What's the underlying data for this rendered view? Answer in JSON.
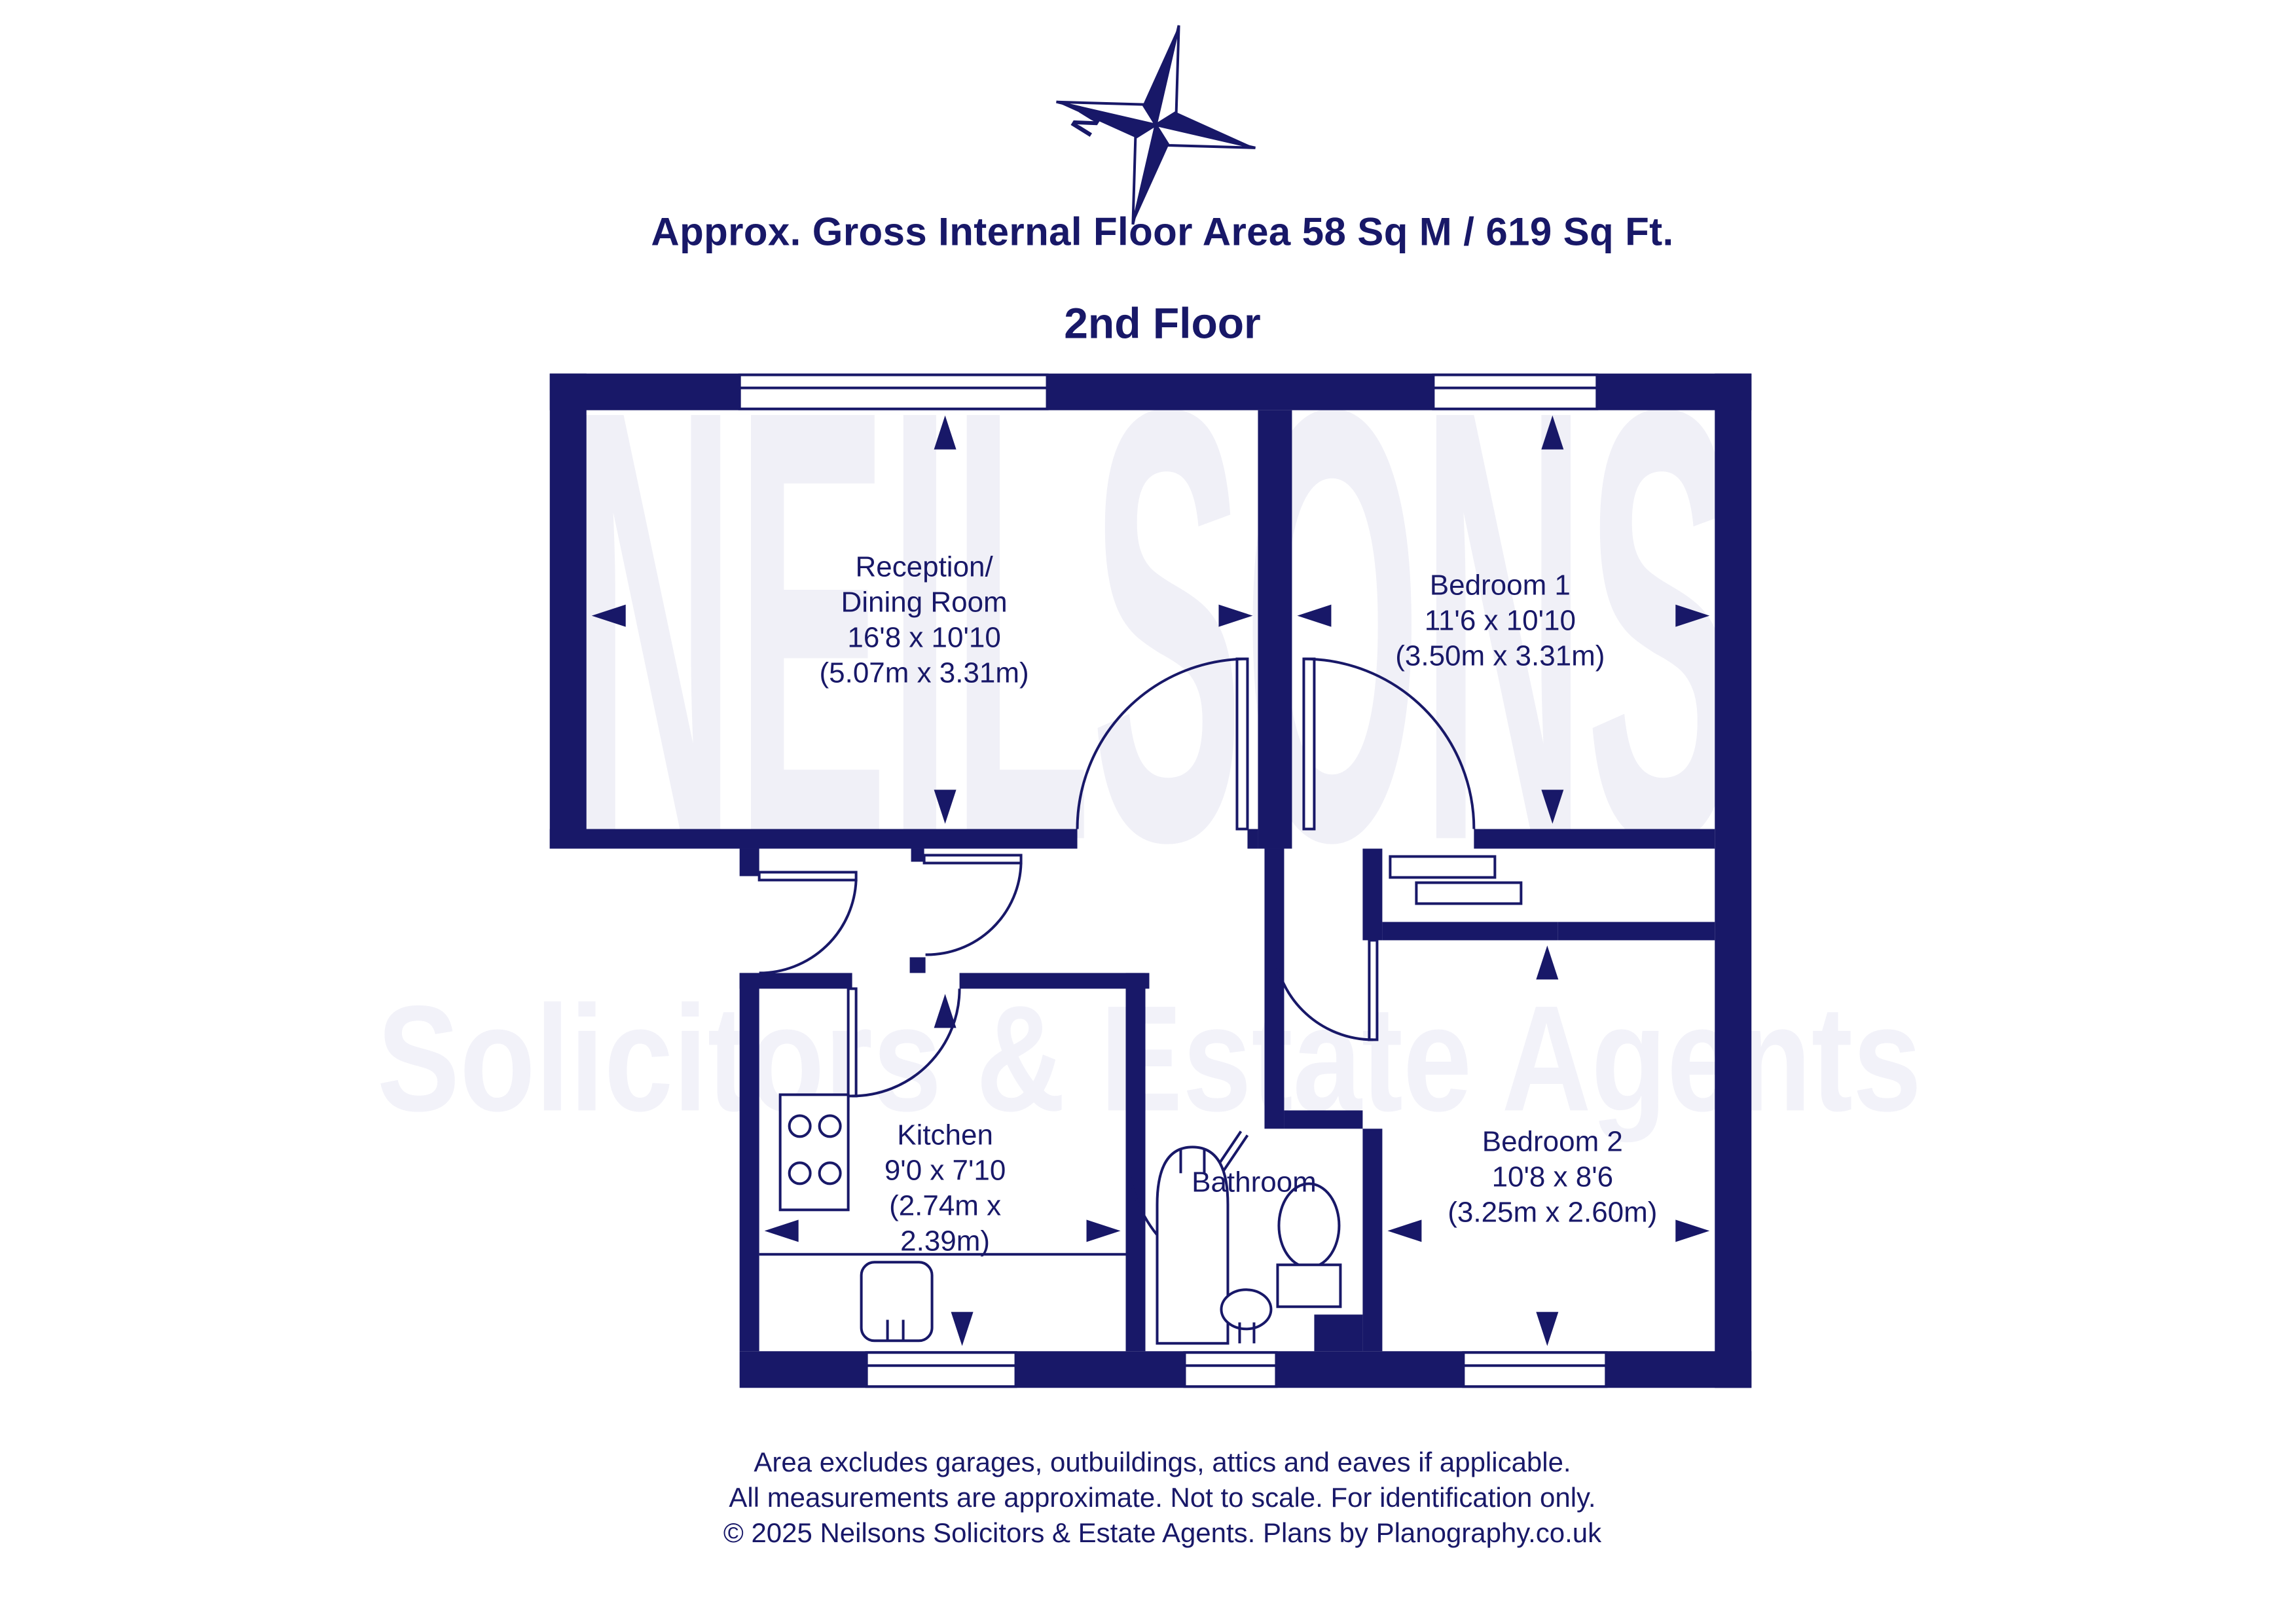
{
  "header": {
    "area_line": "Approx. Gross Internal Floor Area 58 Sq M / 619 Sq Ft.",
    "floor_title": "2nd Floor",
    "compass_north_label": "N"
  },
  "watermark": {
    "line1": "NEILSONS",
    "line2": "Solicitors & Estate Agents"
  },
  "rooms": {
    "reception": {
      "name1": "Reception/",
      "name2": "Dining Room",
      "dims_imperial": "16'8 x 10'10",
      "dims_metric": "(5.07m x 3.31m)"
    },
    "bedroom1": {
      "name": "Bedroom 1",
      "dims_imperial": "11'6 x 10'10",
      "dims_metric": "(3.50m x 3.31m)"
    },
    "kitchen": {
      "name": "Kitchen",
      "dims_imperial": "9'0 x 7'10",
      "dims_metric_line1": "(2.74m x",
      "dims_metric_line2": "2.39m)"
    },
    "bathroom": {
      "name": "Bathroom"
    },
    "bedroom2": {
      "name": "Bedroom 2",
      "dims_imperial": "10'8 x 8'6",
      "dims_metric": "(3.25m x 2.60m)"
    }
  },
  "footer": {
    "line1": "Area excludes garages, outbuildings, attics and eaves if applicable.",
    "line2": "All measurements are approximate. Not to scale. For identification only.",
    "line3": "© 2025 Neilsons Solicitors & Estate Agents. Plans by Planography.co.uk"
  },
  "colors": {
    "navy": "#181868",
    "watermark_light": "#f0f0f7",
    "background": "#ffffff"
  }
}
